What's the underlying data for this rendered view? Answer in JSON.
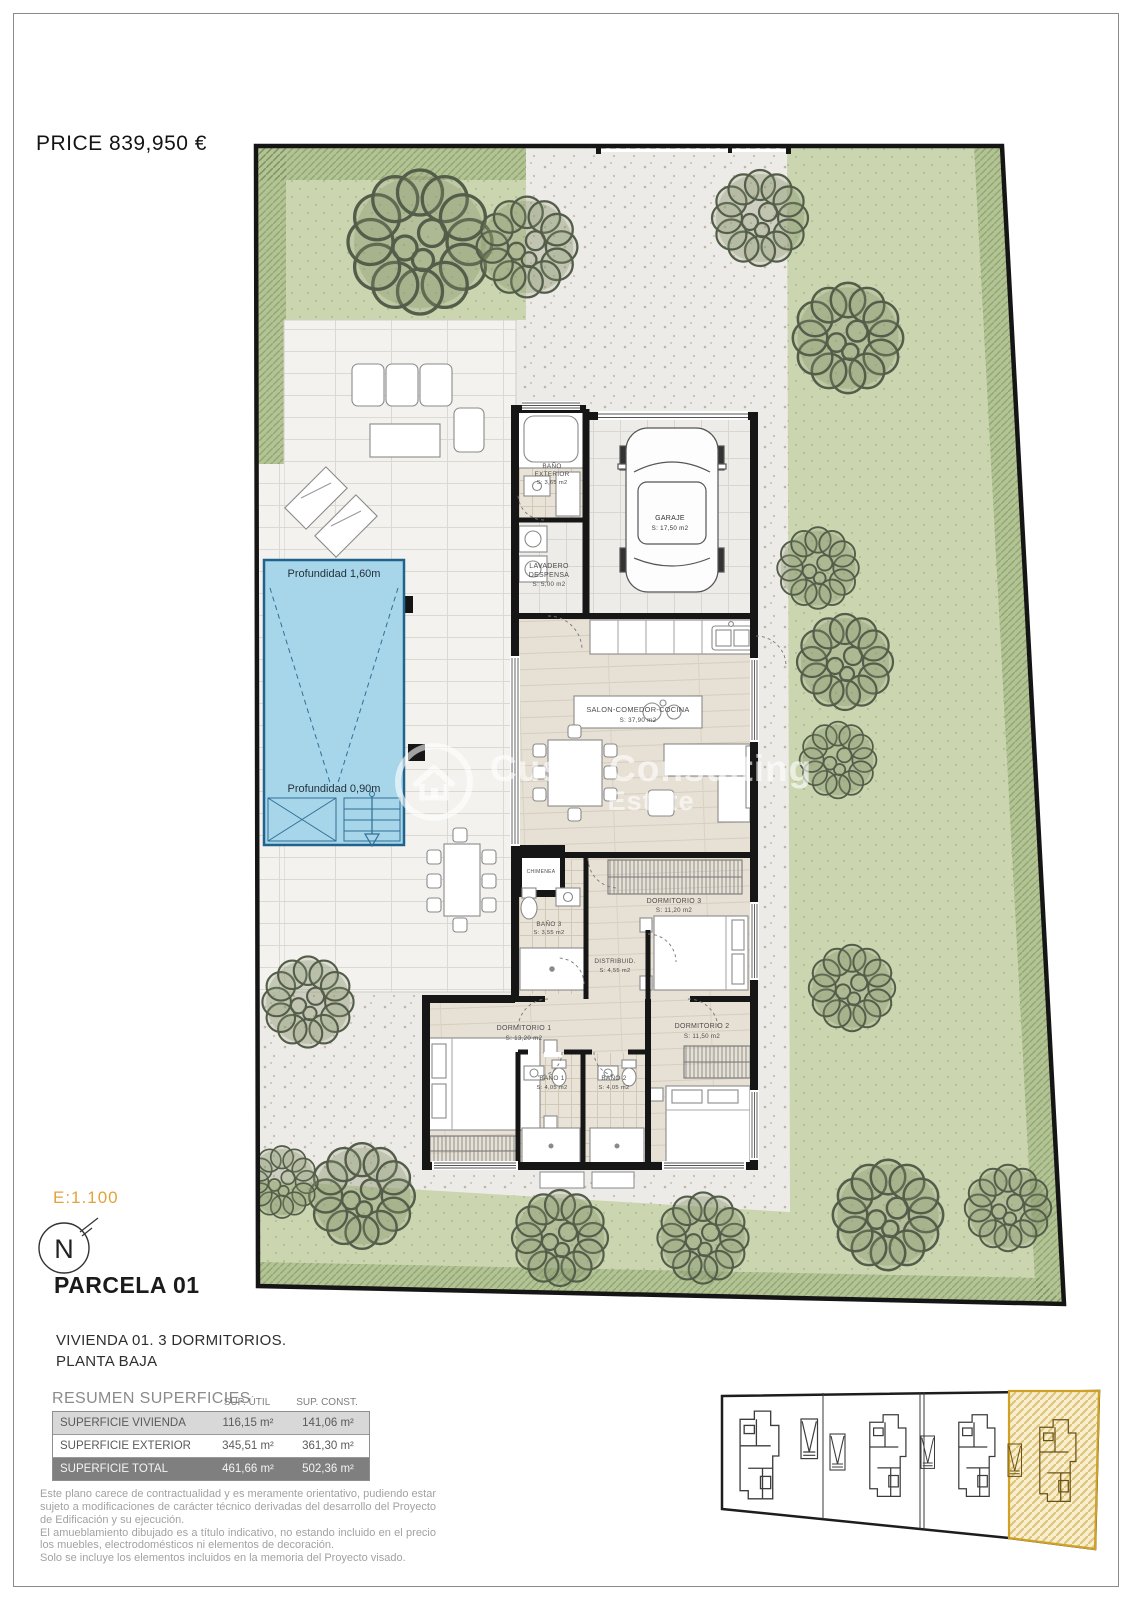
{
  "header": {
    "price": "PRICE 839,950 €"
  },
  "plan": {
    "pool": {
      "depth_top": "Profundidad 1,60m",
      "depth_bottom": "Profundidad 0,90m"
    },
    "rooms": {
      "bano_exterior": {
        "line1": "BAÑO",
        "line2": "EXTERIOR",
        "area": "S: 3,65 m2"
      },
      "garaje": {
        "line1": "GARAJE",
        "area": "S: 17,50 m2"
      },
      "lavadero": {
        "line1": "LAVADERO",
        "line2": "DESPENSA",
        "area": "S: 5,00 m2"
      },
      "salon": {
        "line1": "SALON-COMEDOR-COCINA",
        "area": "S: 37,90 m2"
      },
      "chimenea": {
        "line1": "CHIMENEA"
      },
      "dormitorio3": {
        "line1": "DORMITORIO 3",
        "area": "S: 11,20 m2"
      },
      "bano3": {
        "line1": "BAÑO 3",
        "area": "S: 3,55 m2"
      },
      "distribuidor": {
        "line1": "DISTRIBUID.",
        "area": "S: 4,55 m2"
      },
      "dormitorio1": {
        "line1": "DORMITORIO 1",
        "area": "S: 13,20 m2"
      },
      "bano1": {
        "line1": "BAÑO 1",
        "area": "S: 4,05 m2"
      },
      "bano2": {
        "line1": "BAÑO 2",
        "area": "S: 4,05 m2"
      },
      "dormitorio2": {
        "line1": "DORMITORIO 2",
        "area": "S: 11,50 m2"
      }
    },
    "watermark": {
      "line1": "Custa Consulting",
      "line2": "Estate"
    }
  },
  "legend": {
    "scale": "E:1.100",
    "north": "N",
    "parcel_title": "PARCELA 01",
    "subtitle_line1": "VIVIENDA 01. 3 DORMITORIOS.",
    "subtitle_line2": "PLANTA BAJA"
  },
  "summary_table": {
    "title": "RESUMEN SUPERFICIES",
    "col_util": "SUP. ÚTIL",
    "col_const": "SUP. CONST.",
    "rows": [
      {
        "label": "SUPERFICIE VIVIENDA",
        "util": "116,15 m²",
        "const": "141,06 m²"
      },
      {
        "label": "SUPERFICIE EXTERIOR",
        "util": "345,51 m²",
        "const": "361,30 m²"
      },
      {
        "label": "SUPERFICIE TOTAL",
        "util": "461,66 m²",
        "const": "502,36 m²"
      }
    ]
  },
  "disclaimer": {
    "p1": "Este plano carece de contractualidad y es meramente orientativo, pudiendo estar sujeto a modificaciones de carácter técnico derivadas del desarrollo del Proyecto de Edificación y su ejecución.",
    "p2": "El amueblamiento dibujado es a título indicativo, no estando incluido en el precio los muebles, electrodomésticos ni elementos de decoración.",
    "p3": "Solo se incluye los elementos incluidos en la memoria del Proyecto visado."
  },
  "colors": {
    "scale_accent": "#E2A33C",
    "pool_water": "#A7D6EA",
    "garden_green": "#CBD6B1",
    "parcel_highlight": "#F8EECD",
    "table_total_bg": "#7F7F7F"
  }
}
